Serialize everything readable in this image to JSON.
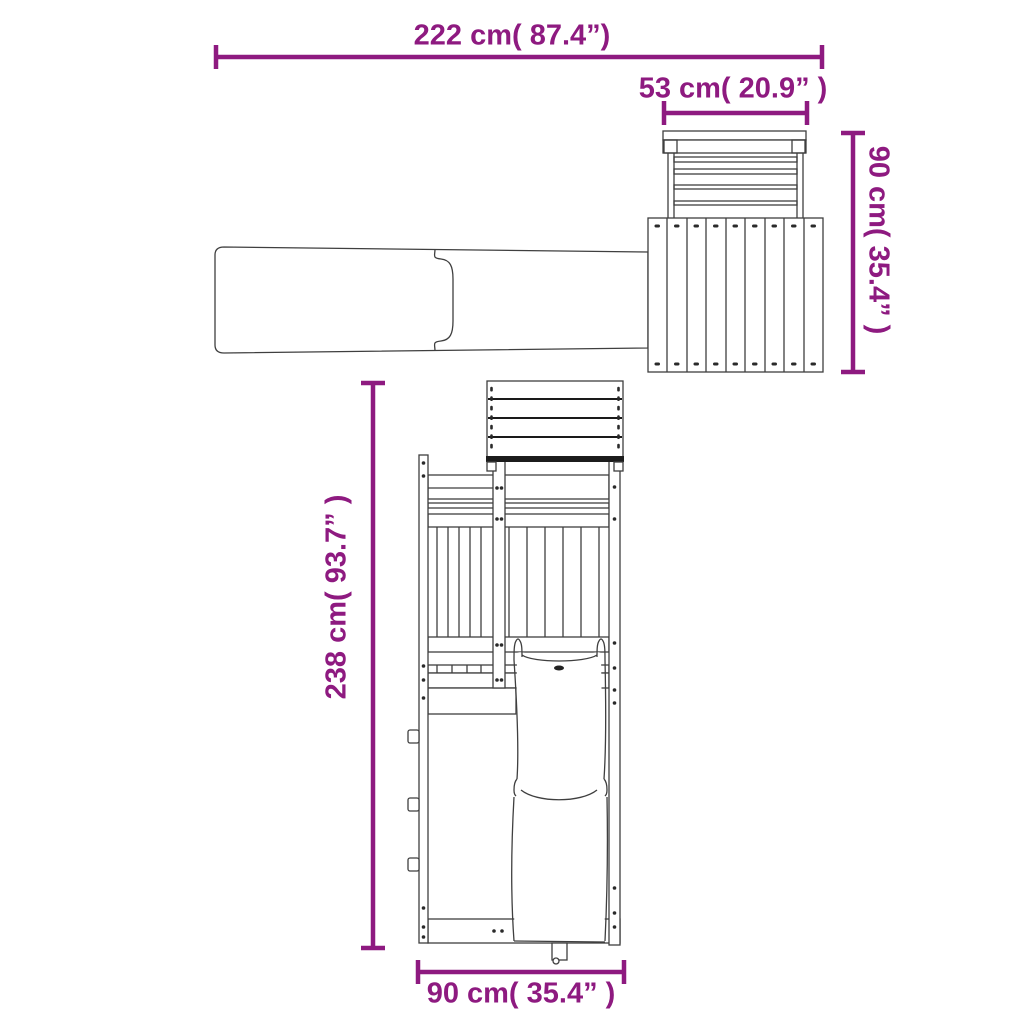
{
  "diagram": {
    "type": "product-dimension-drawing",
    "subject": "wooden playhouse with slide (top view and front view)",
    "accent_color": "#8E1A80",
    "line_color": "#3f3f3f",
    "background_color": "#ffffff",
    "dimensions": {
      "top_width": {
        "label": "222 cm( 87.4”)",
        "value_cm": 222,
        "value_in": 87.4,
        "orientation": "horizontal"
      },
      "railing_width": {
        "label": "53 cm( 20.9” )",
        "value_cm": 53,
        "value_in": 20.9,
        "orientation": "horizontal"
      },
      "side_depth": {
        "label": "90 cm( 35.4” )",
        "value_cm": 90,
        "value_in": 35.4,
        "orientation": "vertical-right"
      },
      "total_height": {
        "label": "238 cm( 93.7” )",
        "value_cm": 238,
        "value_in": 93.7,
        "orientation": "vertical-left"
      },
      "base_width": {
        "label": "90 cm( 35.4” )",
        "value_cm": 90,
        "value_in": 35.4,
        "orientation": "horizontal"
      }
    }
  }
}
